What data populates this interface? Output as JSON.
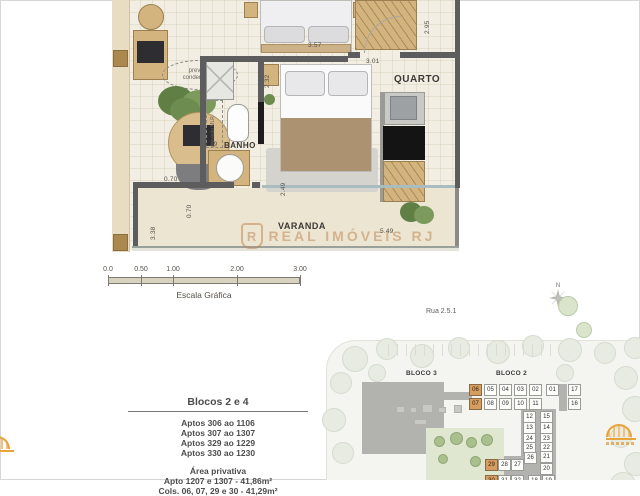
{
  "floorplan": {
    "watermark_text": "REAL IMÓVEIS RJ",
    "watermark_shield_letter": "R",
    "rooms": [
      {
        "text": "QUARTO",
        "x": 282,
        "y": 74,
        "size": 10
      },
      {
        "text": "BANHO",
        "x": 112,
        "y": 141,
        "size": 8
      },
      {
        "text": "VARANDA",
        "x": 166,
        "y": 221,
        "size": 9
      }
    ],
    "notes": {
      "condenser_line1": "previsão",
      "condenser_line2": "condensador",
      "mlr": "previsão MLR"
    },
    "dimensions": [
      {
        "text": "2.95",
        "x": 312,
        "y": 34,
        "rot": true
      },
      {
        "text": "3.57",
        "x": 196,
        "y": 42,
        "rot": false
      },
      {
        "text": "2.32",
        "x": 152,
        "y": 88,
        "rot": true
      },
      {
        "text": "3.01",
        "x": 254,
        "y": 58,
        "rot": false
      },
      {
        "text": "1.29",
        "x": 92,
        "y": 141,
        "rot": false
      },
      {
        "text": "0.70",
        "x": 52,
        "y": 176,
        "rot": false
      },
      {
        "text": "0.70",
        "x": 74,
        "y": 218,
        "rot": true
      },
      {
        "text": "2.49",
        "x": 168,
        "y": 196,
        "rot": true
      },
      {
        "text": "3.38",
        "x": 38,
        "y": 240,
        "rot": true
      },
      {
        "text": "5.49",
        "x": 268,
        "y": 228,
        "rot": false
      }
    ]
  },
  "scalebar": {
    "ticks": [
      "0.0",
      "0.50",
      "1.00",
      "2.00",
      "3.00"
    ],
    "tick_x": [
      0,
      33,
      65,
      129,
      192
    ],
    "label": "Escala Gráfica"
  },
  "info": {
    "title": "Blocos 2 e 4",
    "apt_lines": [
      "Aptos 306 ao 1106",
      "Aptos 307 ao 1307",
      "Aptos 329 ao 1229",
      "Aptos 330 ao 1230"
    ],
    "area_title": "Área privativa",
    "area_lines": [
      "Apto 1207 e  1307 - 41,86m²",
      "Cols. 06, 07, 29 e 30 - 41,29m²"
    ]
  },
  "siteplan": {
    "street": "Rua 2.5.1",
    "north_label": "N",
    "bloco3_label": "BLOCO 3",
    "bloco2_label": "BLOCO 2",
    "highlight_color": "#d69c60",
    "highlighted_units": [
      "06",
      "07",
      "29",
      "30"
    ],
    "units": [
      {
        "label": "06",
        "x": 151,
        "y": 104,
        "hl": true
      },
      {
        "label": "05",
        "x": 166,
        "y": 104,
        "hl": false
      },
      {
        "label": "04",
        "x": 181,
        "y": 104,
        "hl": false
      },
      {
        "label": "03",
        "x": 196,
        "y": 104,
        "hl": false
      },
      {
        "label": "02",
        "x": 211,
        "y": 104,
        "hl": false
      },
      {
        "label": "01",
        "x": 228,
        "y": 104,
        "hl": false
      },
      {
        "label": "17",
        "x": 250,
        "y": 104,
        "hl": false
      },
      {
        "label": "07",
        "x": 151,
        "y": 118,
        "hl": true
      },
      {
        "label": "08",
        "x": 166,
        "y": 118,
        "hl": false
      },
      {
        "label": "09",
        "x": 181,
        "y": 118,
        "hl": false
      },
      {
        "label": "10",
        "x": 196,
        "y": 118,
        "hl": false
      },
      {
        "label": "11",
        "x": 211,
        "y": 118,
        "hl": false
      },
      {
        "label": "16",
        "x": 250,
        "y": 118,
        "hl": false
      },
      {
        "label": "12",
        "x": 205,
        "y": 131,
        "hl": false
      },
      {
        "label": "15",
        "x": 222,
        "y": 131,
        "hl": false
      },
      {
        "label": "13",
        "x": 205,
        "y": 142,
        "hl": false
      },
      {
        "label": "14",
        "x": 222,
        "y": 142,
        "hl": false
      },
      {
        "label": "24",
        "x": 205,
        "y": 153,
        "hl": false
      },
      {
        "label": "23",
        "x": 222,
        "y": 153,
        "hl": false
      },
      {
        "label": "25",
        "x": 205,
        "y": 162,
        "hl": false
      },
      {
        "label": "22",
        "x": 222,
        "y": 162,
        "hl": false
      },
      {
        "label": "26",
        "x": 206,
        "y": 172,
        "hl": false
      },
      {
        "label": "21",
        "x": 222,
        "y": 171,
        "hl": false
      },
      {
        "label": "20",
        "x": 222,
        "y": 183,
        "hl": false
      },
      {
        "label": "29",
        "x": 167,
        "y": 179,
        "hl": true
      },
      {
        "label": "28",
        "x": 180,
        "y": 179,
        "hl": false
      },
      {
        "label": "27",
        "x": 193,
        "y": 179,
        "hl": false
      },
      {
        "label": "30",
        "x": 167,
        "y": 195,
        "hl": true
      },
      {
        "label": "31",
        "x": 180,
        "y": 195,
        "hl": false
      },
      {
        "label": "32",
        "x": 193,
        "y": 195,
        "hl": false
      },
      {
        "label": "18",
        "x": 210,
        "y": 195,
        "hl": false
      },
      {
        "label": "19",
        "x": 224,
        "y": 195,
        "hl": false
      }
    ]
  },
  "icons": {
    "north_compass": "compass-rose",
    "realimoveis_shield": "shield-monogram",
    "agency_logo": "sunrise-rays"
  }
}
